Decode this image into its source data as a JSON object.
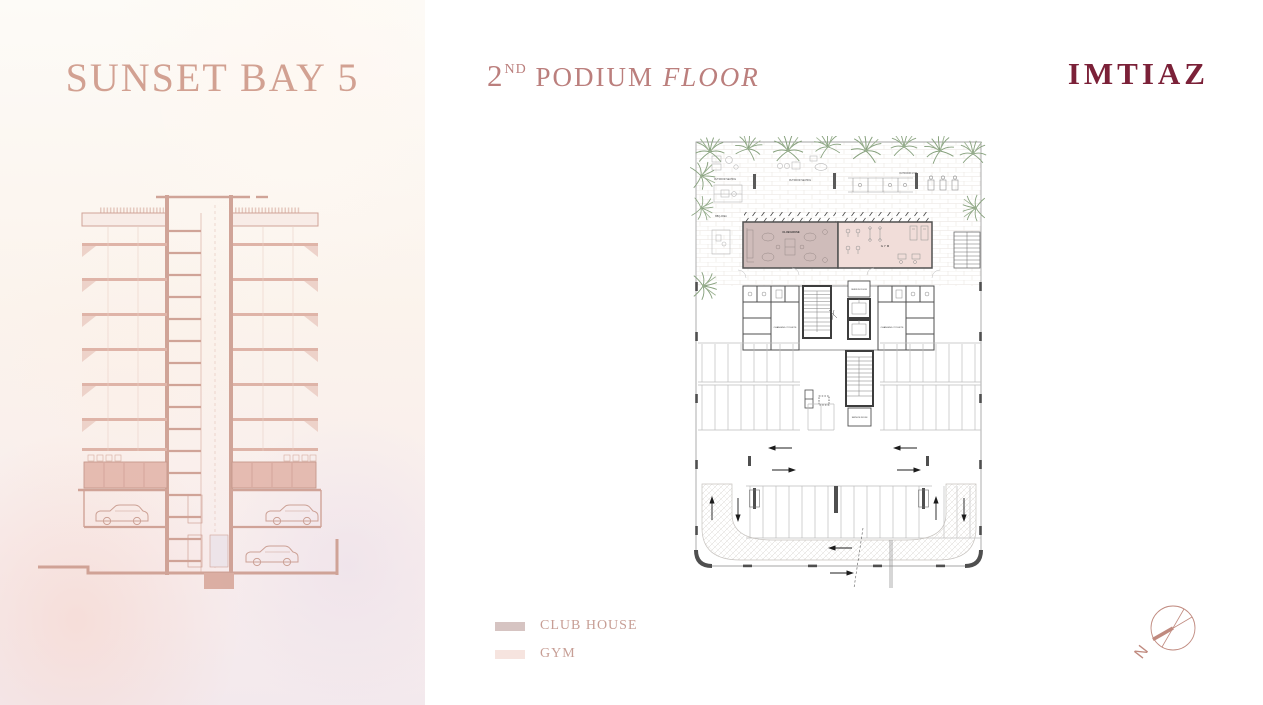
{
  "project": {
    "title": "SUNSET BAY 5"
  },
  "heading": {
    "number": "2",
    "ordinal": "ND",
    "word": "PODIUM",
    "floor_italic": "FLOOR"
  },
  "brand": {
    "name": "IMTIAZ",
    "color": "#7b2138"
  },
  "legend": {
    "items": [
      {
        "label": "CLUB HOUSE",
        "color": "#d6c4c2"
      },
      {
        "label": "GYM",
        "color": "#f6e4df"
      }
    ]
  },
  "compass": {
    "north": "N"
  },
  "floor_plan": {
    "labels": {
      "outdoor_seating_left": "OUTDOOR SEATING",
      "outdoor_seating_center": "OUTDOOR SEATING",
      "outdoor_gym": "OUTDOOR GYM",
      "bbq_area": "BBQ AREA",
      "club_house": "CLUB HOUSE",
      "gym": "G Y M",
      "changing_toilets_left": "CHANGING / TOILETS",
      "changing_toilets_right": "CHANGING / TOILETS",
      "service_room_top": "SERVICE ROOM",
      "service_room_bottom": "SERVICE ROOM"
    },
    "colors": {
      "club_house_fill": "#cfbcba",
      "gym_fill": "#f1ddd9",
      "wall": "#4f4f4f",
      "palm": "#86a07c",
      "title_rose": "#d2a192",
      "heading_rose": "#bb7f7d"
    }
  }
}
